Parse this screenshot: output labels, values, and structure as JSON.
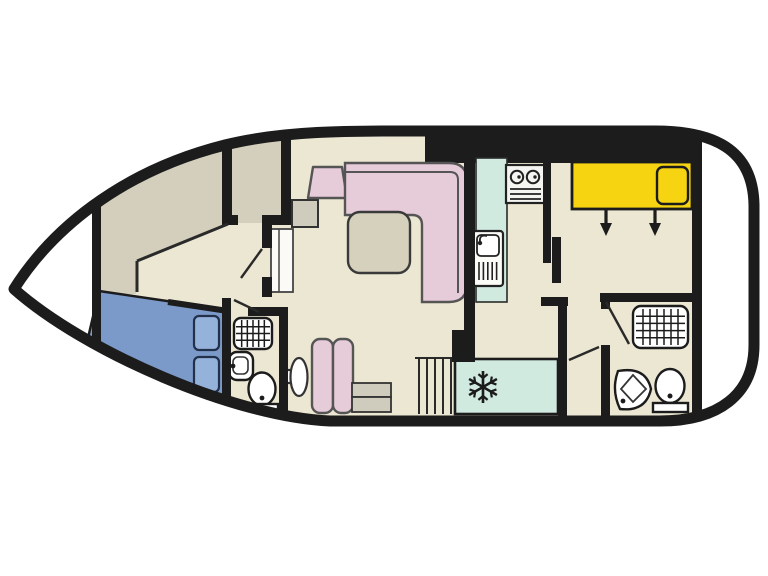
{
  "diagram": {
    "kind": "houseboat-floor-plan",
    "icons": [
      "snowflake-icon",
      "stove-icon",
      "sink-icon",
      "shower-icon",
      "washbasin-icon",
      "toilet-icon",
      "stairs-icon",
      "arrow-down-icon",
      "bed-icon",
      "sofa-icon",
      "table-icon",
      "wardrobe-icon",
      "pillow-icon",
      "steps-icon"
    ]
  },
  "colors": {
    "white": "#ffffff",
    "hull": "#1c1c1c",
    "line": "#2a2a2a",
    "floor": "#ece7d2",
    "deck": "#d3cfbc",
    "bed_blue": "#7b9ac9",
    "pillow_blue": "#94b2da",
    "pink": "#e6cbd9",
    "pink_outline": "#555555",
    "yellow": "#f7d412",
    "mint": "#d0eae0",
    "tan": "#d5d1bd",
    "gray": "#cfccbd",
    "fixture": "#ffffff"
  }
}
